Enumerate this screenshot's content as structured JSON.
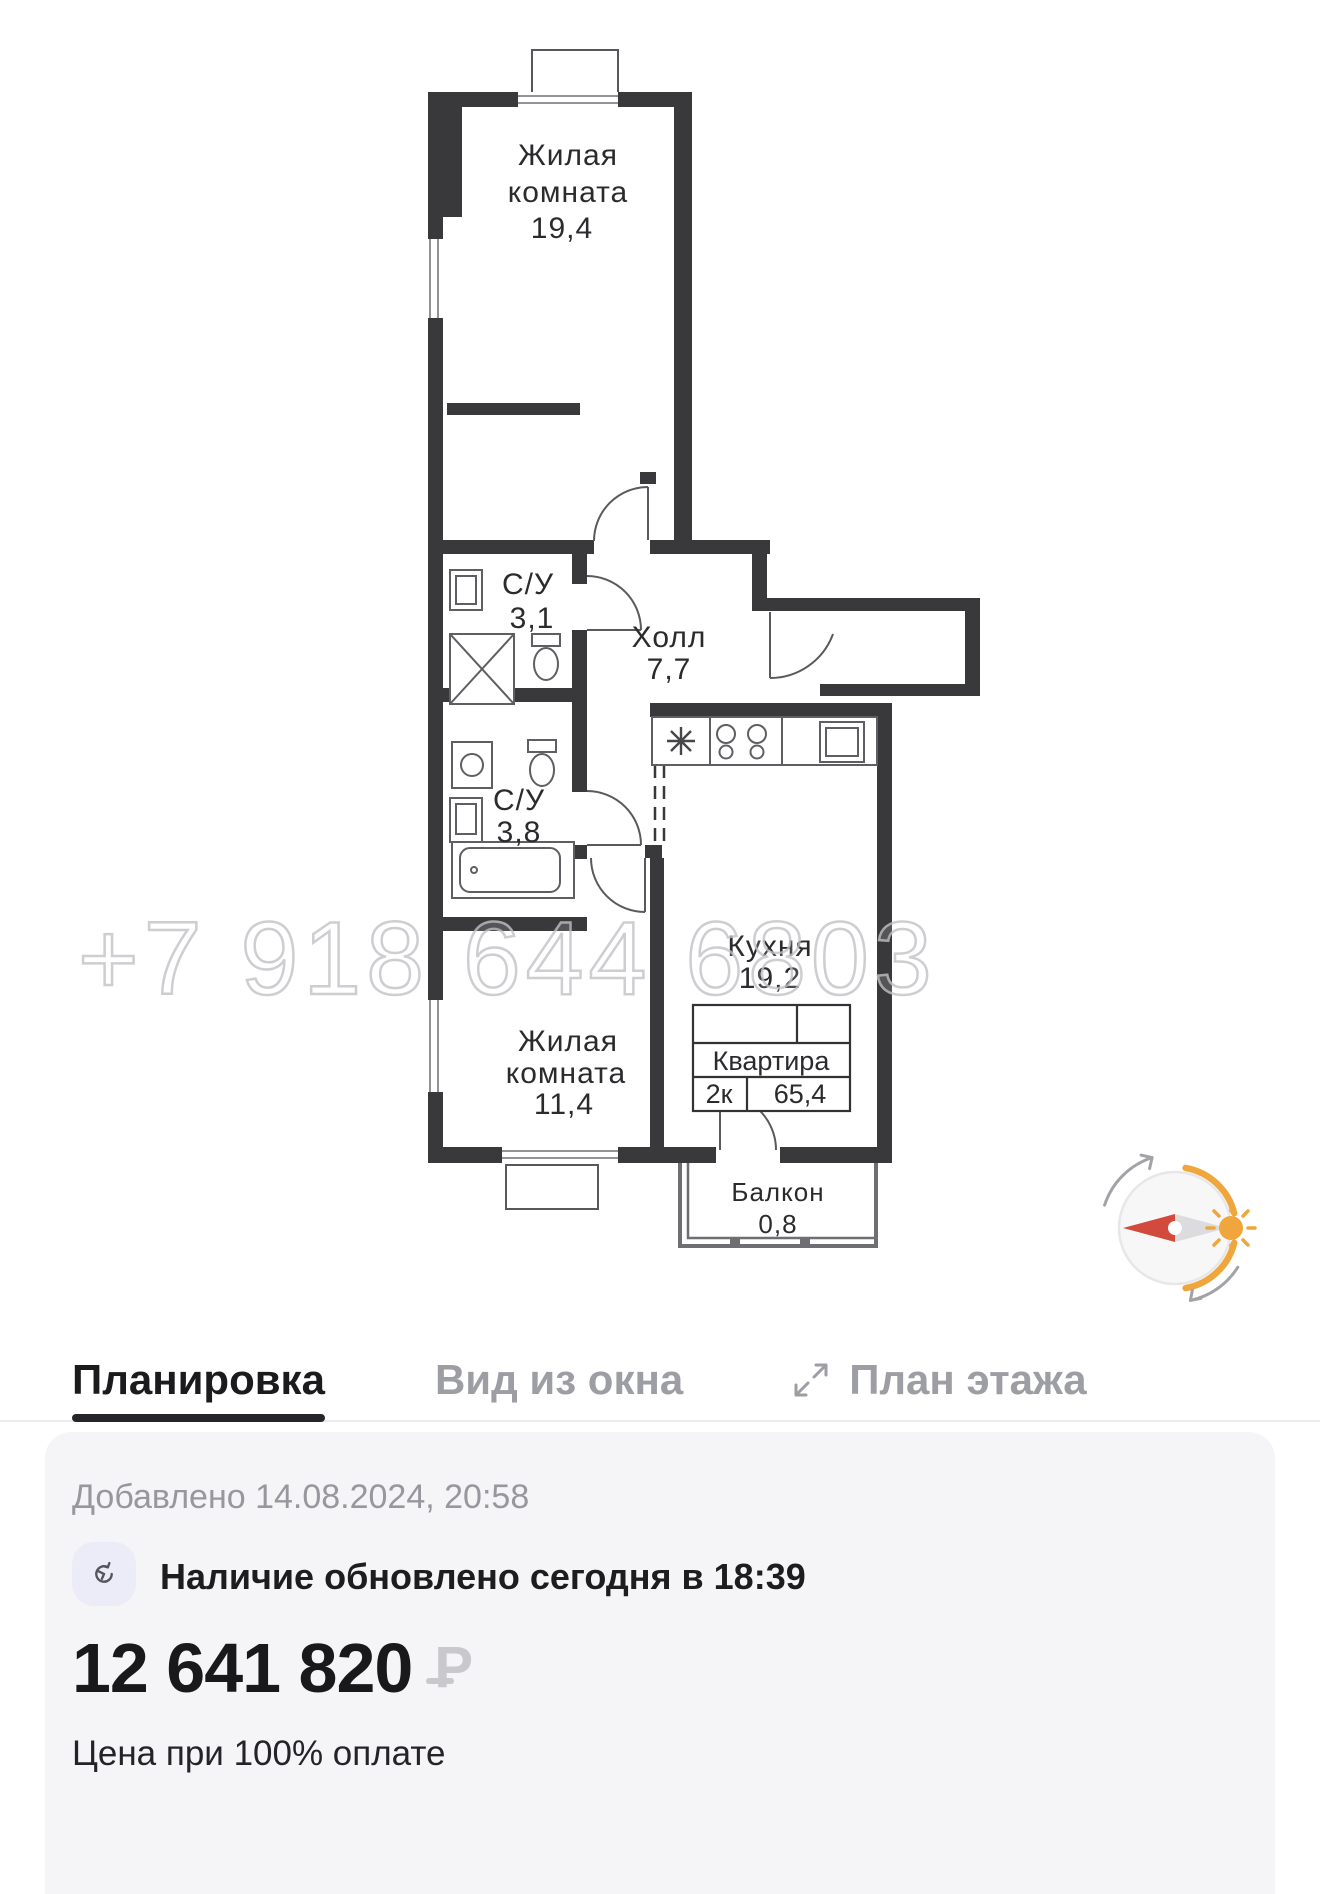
{
  "plan": {
    "watermark": "+7 918 644 6803",
    "room_top": {
      "line1": "Жилая",
      "line2": "комната",
      "area": "19,4"
    },
    "wc_small": {
      "name": "С/У",
      "area": "3,1"
    },
    "hall": {
      "name": "Холл",
      "area": "7,7"
    },
    "wc_big": {
      "name": "С/У",
      "area": "3,8"
    },
    "kitchen": {
      "name": "Кухня",
      "area": "19,2"
    },
    "room_bottom": {
      "line1": "Жилая",
      "line2": "комната",
      "area": "11,4"
    },
    "balcony": {
      "name": "Балкон",
      "area": "0,8"
    },
    "info_table": {
      "title": "Квартира",
      "type": "2к",
      "area": "65,4"
    }
  },
  "tabs": {
    "tab1": "Планировка",
    "tab2": "Вид из окна",
    "tab3": "План этажа"
  },
  "details": {
    "added": "Добавлено 14.08.2024, 20:58",
    "availability": "Наличие обновлено сегодня в 18:39",
    "price": "12 641 820",
    "currency": "₽",
    "price_note": "Цена при 100% оплате"
  },
  "colors": {
    "accent_orange": "#EFA63D",
    "compass_red": "#D24A3C",
    "compass_gray": "#DCDCDE",
    "active_tab": "#1B1B1E",
    "inactive_tab": "#9D9DA4",
    "card_bg": "#F5F5F7"
  }
}
